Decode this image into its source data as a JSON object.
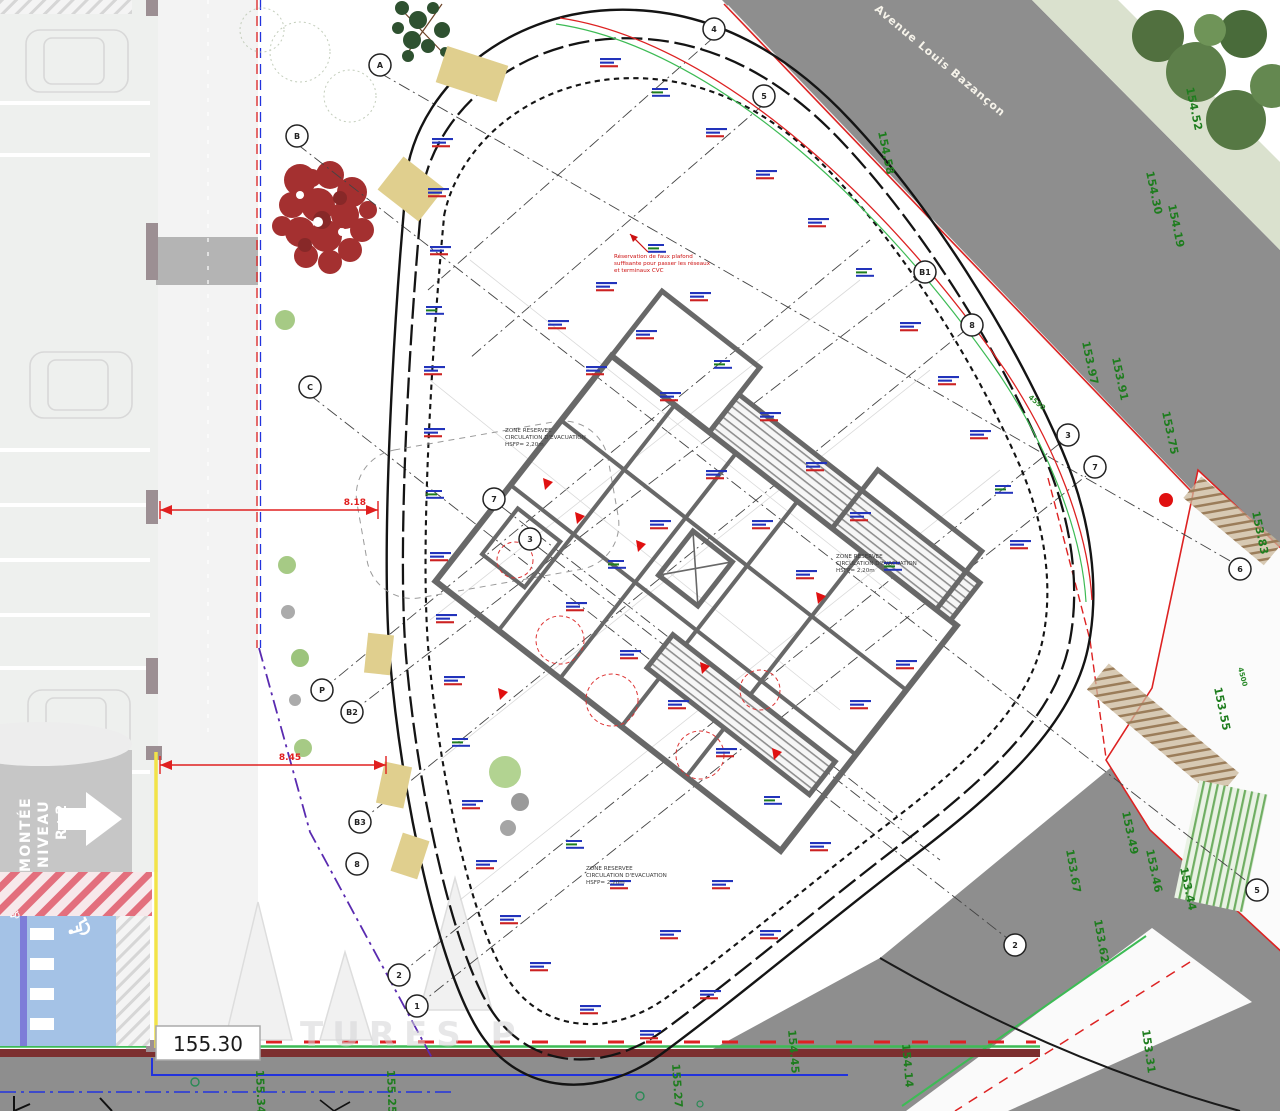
{
  "street_name": "Avenue Louis Bazançon",
  "ramp": {
    "l1": "MONTÉE",
    "l2": "NIVEAU",
    "l3": "R+2"
  },
  "level_box": "155.30",
  "dimensions": {
    "dim1": "8.18",
    "dim2": "8.45"
  },
  "site_dims": {
    "d1": "4590",
    "d2": "4500"
  },
  "zone_note": {
    "l1": "ZONE RESERVEE",
    "l2": "CIRCULATION D'EVACUATION",
    "l3": "HSFP= 2,20m"
  },
  "ceiling_note": {
    "l1": "Réservation de faux plafond",
    "l2": "suffisante pour passer les réseaux",
    "l3": "et terminaux CVC"
  },
  "watermark": "TURES  P",
  "wheelchair_icon": "♿",
  "spot_elevations": [
    "154.52",
    "154.58",
    "154.30",
    "154.19",
    "153.97",
    "153.91",
    "153.75",
    "153.83",
    "153.55",
    "153.49",
    "153.46",
    "153.44",
    "153.62",
    "153.67",
    "154.45",
    "154.14",
    "153.31",
    "155.27",
    "155.34",
    "155.25"
  ],
  "grid_bubbles": [
    "A",
    "B",
    "C",
    "7",
    "3",
    "P",
    "B2",
    "B3",
    "8",
    "2",
    "1",
    "4",
    "5",
    "B1",
    "8",
    "3",
    "7",
    "6",
    "5",
    "2"
  ],
  "palette": {
    "road_gray": "#8e8e8e",
    "verge_green": "#dae1ce",
    "boundary_red": "#dd2222",
    "elevation_green": "#1e7d1e",
    "pmr_blue": "#a4c2e6",
    "facade_tan": "#e0cf8e",
    "site_yellow": "#f2e348",
    "property_purple": "#5a2bb0",
    "annotation_blue": "#2233bb",
    "green_line": "#3dbb55"
  }
}
